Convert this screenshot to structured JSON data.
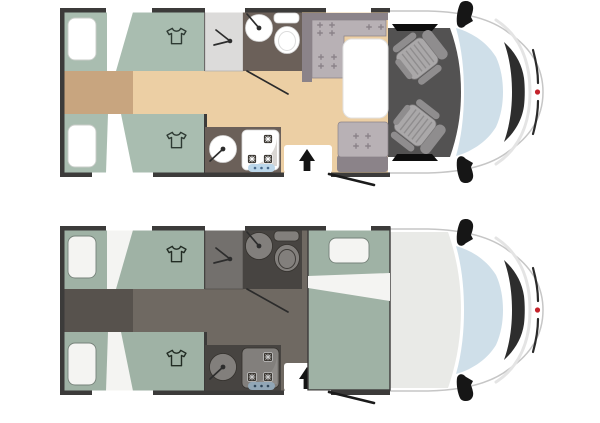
{
  "canvas": {
    "width": 600,
    "height": 402,
    "background": "#ffffff"
  },
  "colors": {
    "paper": "#ffffff",
    "wall": "#3c3b3a",
    "floor_wood": "#eccfa4",
    "floor_accent": "#c8a57f",
    "floor_night": "#6f6962",
    "floor_accent_night": "#57524d",
    "bed_day": "#a9bdb0",
    "bed_night": "#9fb2a5",
    "linen_day": "#ffffff",
    "linen_night": "#f4f4f2",
    "wet_day": "#6b6059",
    "wet_night": "#474441",
    "shower_day": "#dcdbda",
    "shower_night": "#73706d",
    "fixture_day": "#ffffff",
    "fixture_night": "#827f7c",
    "bench_dark": "#8b8389",
    "bench_light": "#b8b1b5",
    "table": "#ffffff",
    "cab_floor": "#535252",
    "cab_inner_night": "#e9eae7",
    "seat_light": "#aaa8a9",
    "seat_dark": "#8f8d8e",
    "body": "#ffffff",
    "body_outline": "#c6c6c6",
    "windshield": "#cfdfe9",
    "dash": "#2d2d2d",
    "panel_day": "#bcd7ea",
    "panel_night": "#91a6b6",
    "brand_red": "#c4232b"
  },
  "icons": {
    "wardrobe": "tshirt-icon",
    "shower": "shower-spray-icon",
    "entry": "up-arrow-icon",
    "faucet": "faucet-line-dot-icon",
    "hob_burner": "crossed-burner-icon",
    "upholstery": "plus-mark",
    "brand": "red-dot"
  },
  "plans": [
    {
      "id": "plan-day",
      "variant": "day-layout",
      "features": [
        "twin-rear-beds",
        "two-wardrobe-tshirt-icons",
        "shower-cubicle",
        "washbasin",
        "toilet",
        "kitchen-sink",
        "three-burner-hob",
        "control-strip",
        "entry-door-arrow",
        "open-door-line",
        "l-shaped-dinette-bench",
        "dinette-table",
        "front-bench",
        "two-swivel-cab-seats",
        "cab-windshield",
        "two-side-mirrors"
      ]
    },
    {
      "id": "plan-night",
      "variant": "night-layout",
      "features": [
        "twin-rear-beds",
        "two-wardrobe-tshirt-icons",
        "shower-cubicle",
        "washbasin",
        "toilet",
        "kitchen-sink",
        "three-burner-hob",
        "control-strip",
        "entry-door-arrow",
        "open-door-line",
        "dinette-converted-bed",
        "cab-windshield",
        "two-side-mirrors"
      ]
    }
  ]
}
